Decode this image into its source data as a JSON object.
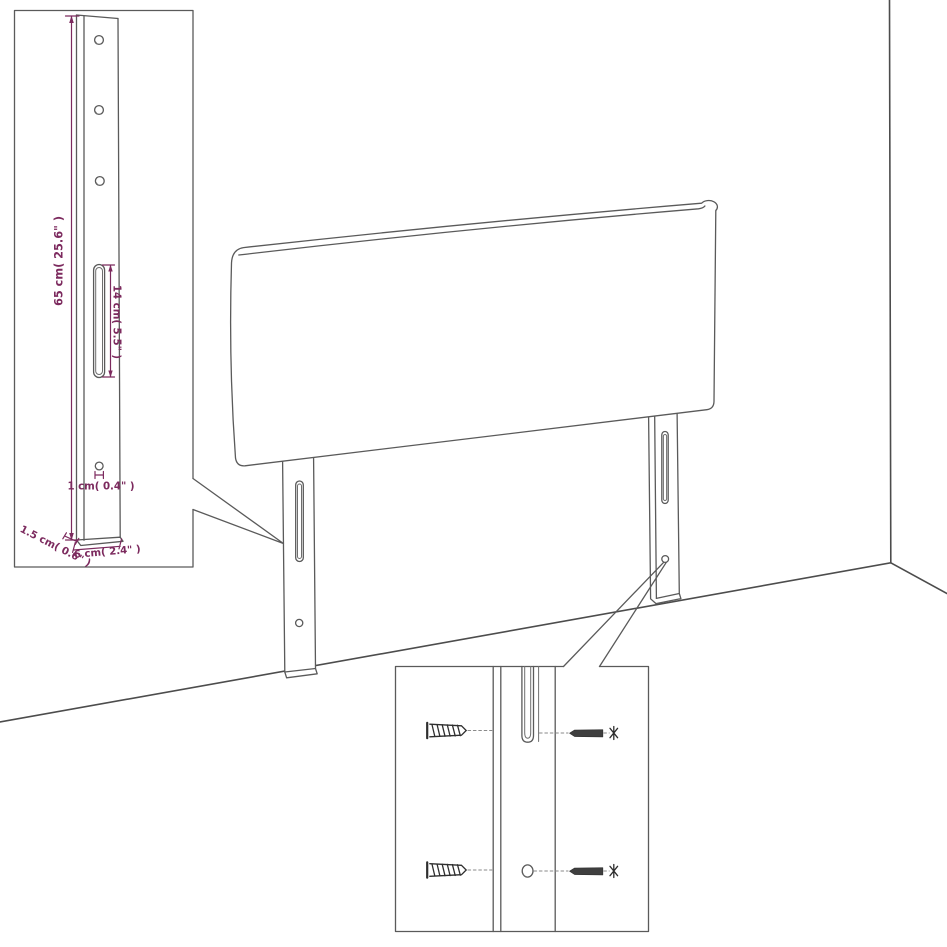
{
  "figure": {
    "type": "headboard-assembly-dimension-diagram",
    "labels": {
      "leg_height": "65 cm( 25.6\" )",
      "slot_length": "14 cm( 5.5\" )",
      "hole_diameter": "1 cm( 0.4\" )",
      "leg_thickness": "1.5 cm( 0.6\" )",
      "leg_width": "6 cm( 2.4\" )"
    },
    "colors": {
      "dimension": "#7c2a5e",
      "outline": "#5a5a5a",
      "background": "#ffffff"
    }
  }
}
